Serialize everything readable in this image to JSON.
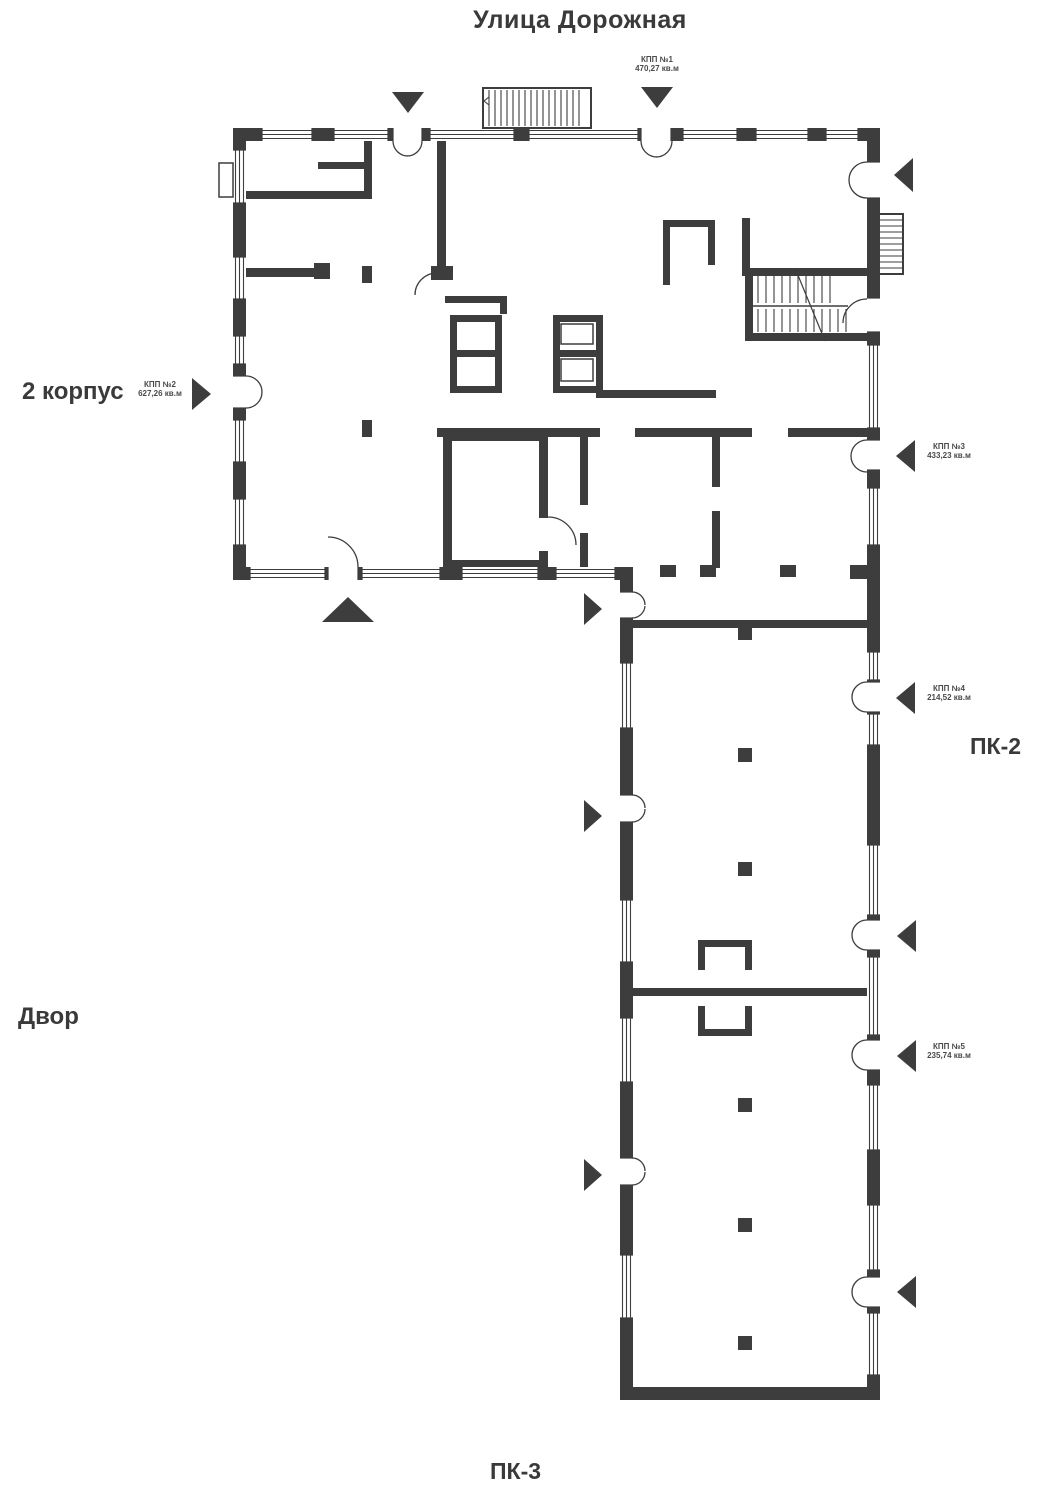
{
  "colors": {
    "wall": "#3d3d3d",
    "text": "#3a3a3a",
    "small_label": "#4a4a4a",
    "background": "#ffffff"
  },
  "labels": {
    "street": "Улица Дорожная",
    "building": "2 корпус",
    "yard": "Двор",
    "pk2": "ПК-2",
    "pk3": "ПК-3"
  },
  "area_labels": [
    {
      "name": "КПП №1",
      "area": "470,27 кв.м"
    },
    {
      "name": "КПП №2",
      "area": "627,26 кв.м"
    },
    {
      "name": "КПП №3",
      "area": "433,23 кв.м"
    },
    {
      "name": "КПП №4",
      "area": "214,52 кв.м"
    },
    {
      "name": "КПП №5",
      "area": "235,74 кв.м"
    }
  ]
}
